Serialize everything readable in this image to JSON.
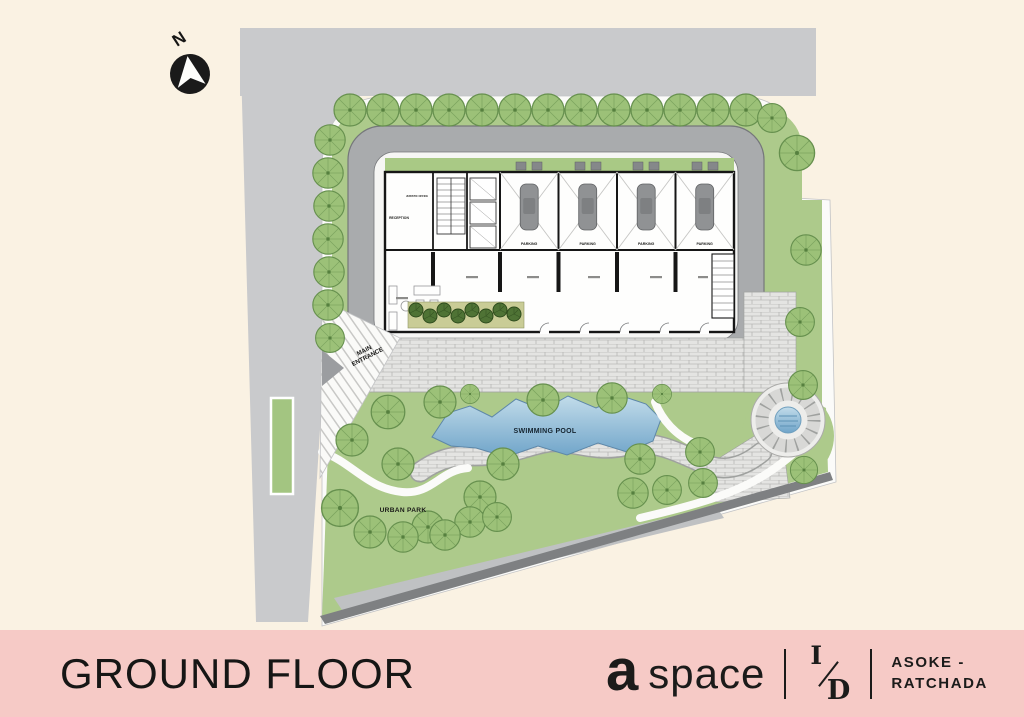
{
  "compass": {
    "north_label": "N"
  },
  "plan": {
    "labels": {
      "main_entrance_line1": "MAIN",
      "main_entrance_line2": "ENTRANCE",
      "swimming_pool": "SWIMMING POOL",
      "urban_park": "URBAN PARK",
      "reception": "RECEPTION",
      "juristic_office": "JURISTIC OFFICE",
      "parking": "PARKING"
    },
    "colors": {
      "background_cream": "#FAF2E3",
      "site_gray": "#C9CACC",
      "road_gray": "#A9ABAD",
      "landscape_green": "#ADCA8B",
      "tree_green": "#9CC178",
      "pool_blue": "#7FB0D3",
      "paver_gray": "#E4E4E2",
      "footer_pink": "#F6CAC6"
    }
  },
  "footer": {
    "title": "GROUND FLOOR",
    "brand": {
      "logo_a": "a",
      "logo_space": "space",
      "monogram_top": "I",
      "monogram_bottom": "D",
      "location_line1": "ASOKE -",
      "location_line2": "RATCHADA"
    }
  }
}
